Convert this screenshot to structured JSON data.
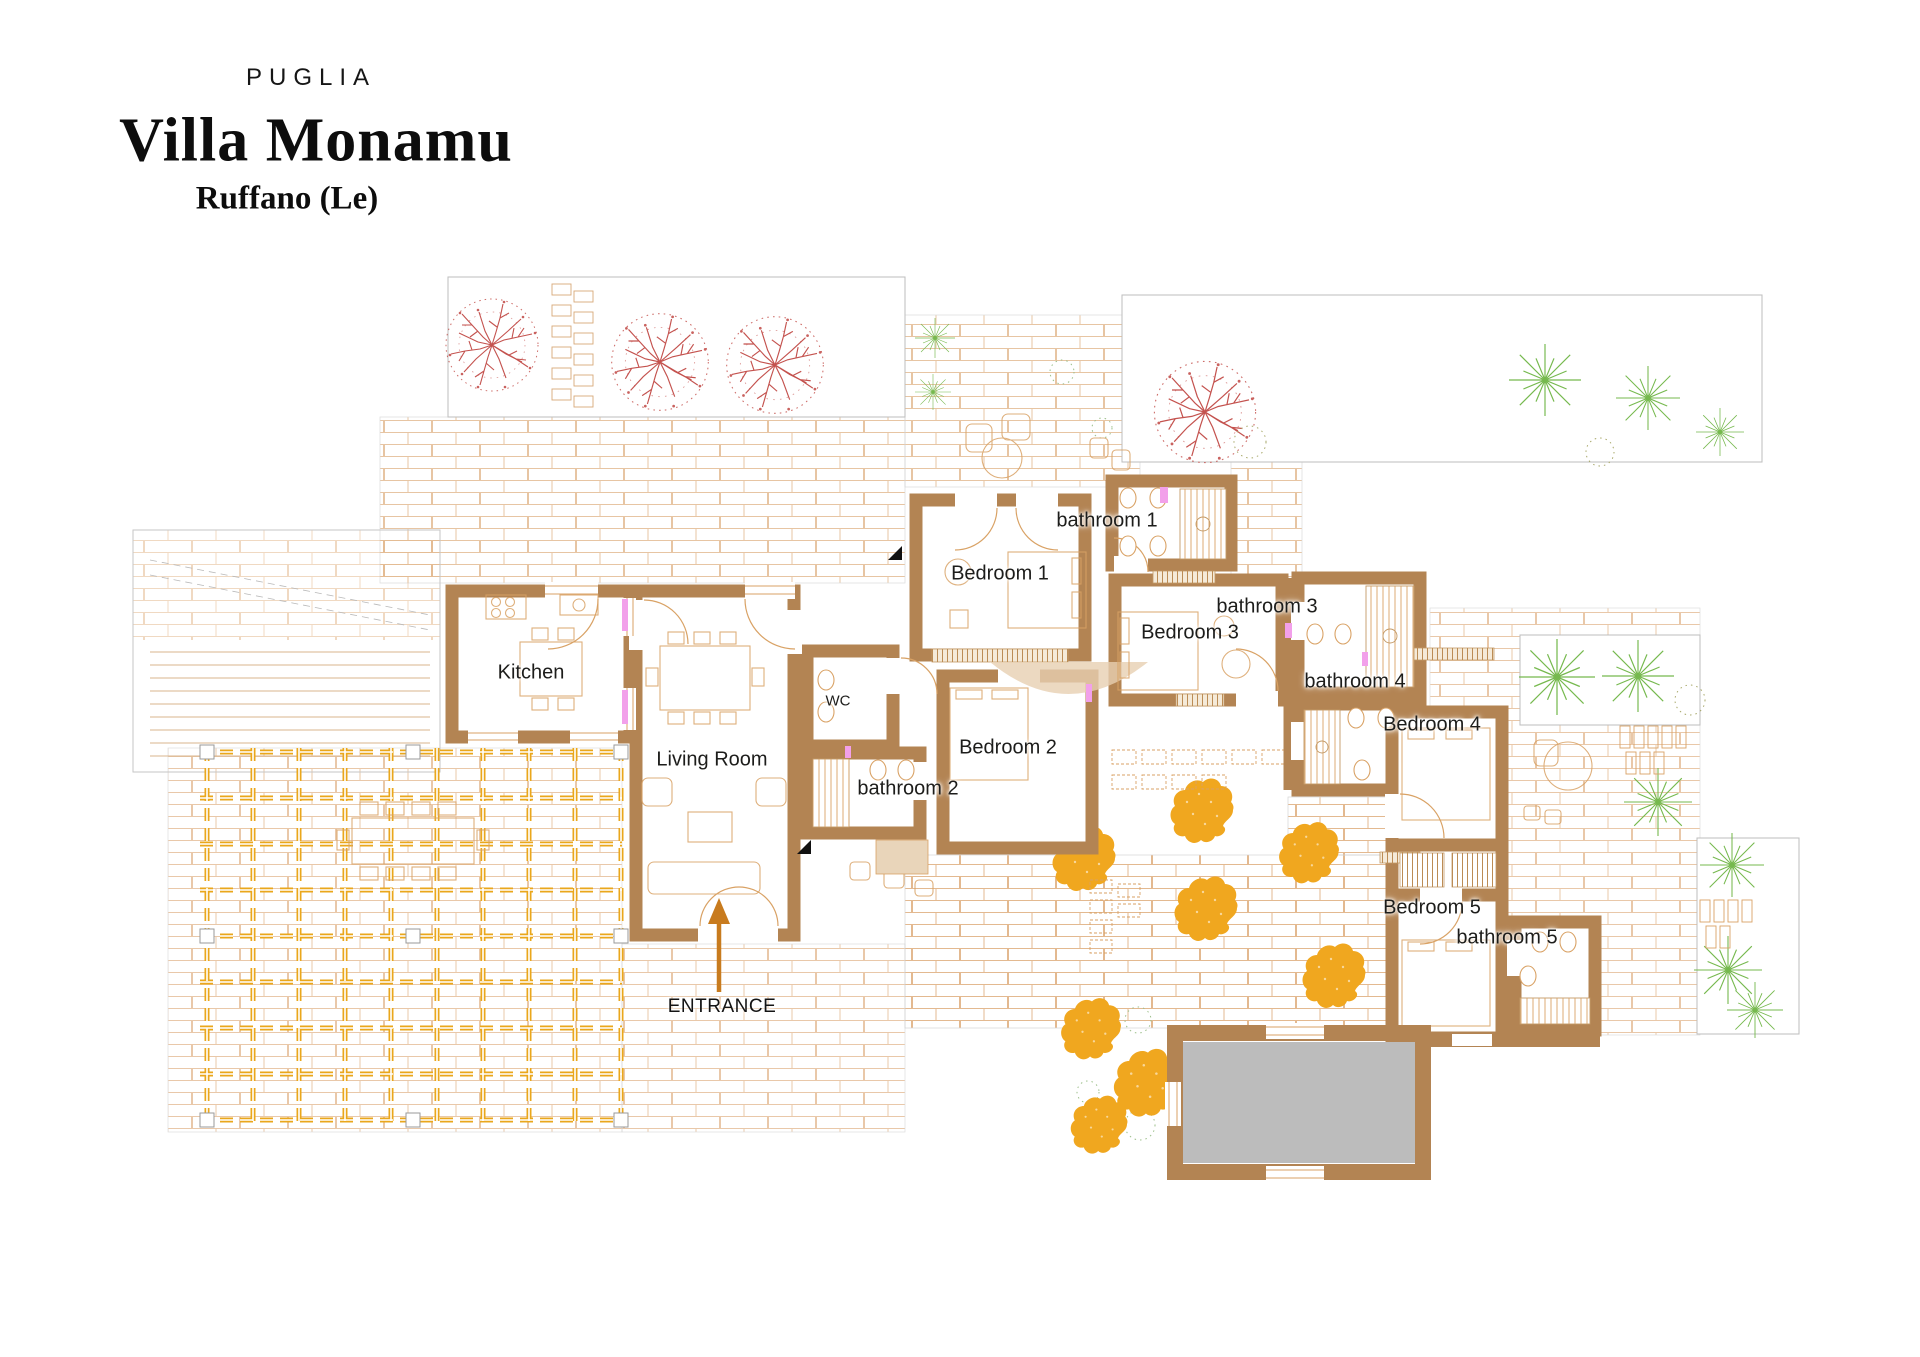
{
  "title": {
    "region": "PUGLIA",
    "name": "Villa Monamu",
    "location": "Ruffano (Le)"
  },
  "rooms": [
    {
      "id": "kitchen",
      "label": "Kitchen"
    },
    {
      "id": "living-room",
      "label": "Living Room"
    },
    {
      "id": "wc",
      "label": "WC"
    },
    {
      "id": "bathroom-2",
      "label": "bathroom 2"
    },
    {
      "id": "bedroom-1",
      "label": "Bedroom 1"
    },
    {
      "id": "bathroom-1",
      "label": "bathroom 1"
    },
    {
      "id": "bedroom-2",
      "label": "Bedroom 2"
    },
    {
      "id": "bedroom-3",
      "label": "Bedroom 3"
    },
    {
      "id": "bathroom-3",
      "label": "bathroom 3"
    },
    {
      "id": "bathroom-4",
      "label": "bathroom 4"
    },
    {
      "id": "bedroom-4",
      "label": "Bedroom 4"
    },
    {
      "id": "bedroom-5",
      "label": "Bedroom 5"
    },
    {
      "id": "bathroom-5",
      "label": "bathroom 5"
    }
  ],
  "annotations": {
    "entrance": "ENTRANCE"
  },
  "colors": {
    "wall": "#b38453",
    "brick_line": "#e0b285",
    "pergola": "#eaa71c",
    "bush": "#f0a71f",
    "tree": "#c4524e",
    "palm": "#76b94e",
    "pool": "#bcbcbc",
    "accent_pink": "#f2a0ea",
    "arrow": "#c87b1e",
    "furniture_line": "#d9a265",
    "label_text": "#1d1d1b"
  }
}
